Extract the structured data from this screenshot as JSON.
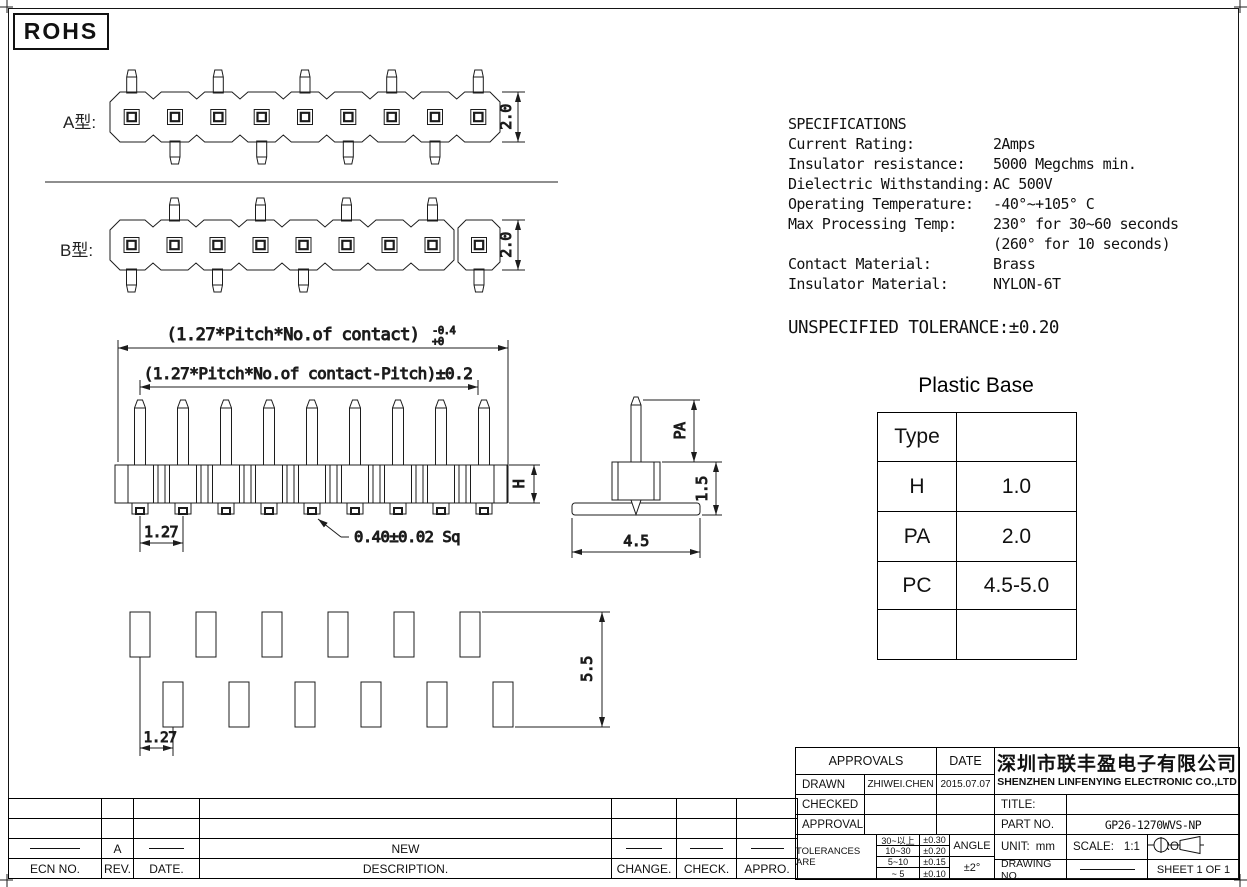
{
  "badge": {
    "rohs": "ROHS"
  },
  "views": {
    "type_a_label": "A型:",
    "type_b_label": "B型:"
  },
  "dims": {
    "a_height": "2.0",
    "b_height": "2.0",
    "total_len": "(1.27*Pitch*No.of contact)",
    "total_len_tol_upper": "-0.4",
    "total_len_tol_lower": "+0",
    "span_len": "(1.27*Pitch*No.of contact-Pitch)±0.2",
    "pitch": "1.27",
    "pin_square": "0.40±0.02 Sq",
    "body_h": "H",
    "pin_above": "PA",
    "base_th": "1.5",
    "base_w": "4.5",
    "pad_span": "5.5",
    "pad_pitch": "1.27"
  },
  "specs": {
    "title": "SPECIFICATIONS",
    "rows": [
      {
        "label": "Current Rating:",
        "value": "2Amps"
      },
      {
        "label": "Insulator resistance:",
        "value": "5000 Megchms min."
      },
      {
        "label": "Dielectric Withstanding:",
        "value": "AC 500V"
      },
      {
        "label": "Operating Temperature:",
        "value": "-40°~+105° C"
      },
      {
        "label": "Max Processing Temp:",
        "value": "230° for 30~60 seconds"
      },
      {
        "label": "",
        "value": "(260° for 10 seconds)"
      },
      {
        "label": "Contact Material:",
        "value": "Brass"
      },
      {
        "label": "Insulator Material:",
        "value": "NYLON-6T"
      }
    ],
    "tolerance_note": "UNSPECIFIED TOLERANCE:±0.20"
  },
  "plastic_table": {
    "title": "Plastic Base",
    "rows": [
      {
        "label": "Type",
        "value": ""
      },
      {
        "label": "H",
        "value": "1.0"
      },
      {
        "label": "PA",
        "value": "2.0"
      },
      {
        "label": "PC",
        "value": "4.5-5.0"
      },
      {
        "label": "",
        "value": ""
      }
    ]
  },
  "revision_table": {
    "headers": [
      "ECN NO.",
      "REV.",
      "DATE.",
      "DESCRIPTION.",
      "CHANGE.",
      "CHECK.",
      "APPRO."
    ],
    "entry": {
      "rev": "A",
      "description": "NEW"
    }
  },
  "title_block": {
    "approvals_header": "APPROVALS",
    "date_header": "DATE",
    "drawn_label": "DRAWN",
    "drawn_name": "ZHIWEI.CHEN",
    "drawn_date": "2015.07.07",
    "checked_label": "CHECKED",
    "approvals_label": "APPROVALS",
    "tolerances_label": "TOLERANCES ARE",
    "tolerance_rows": [
      {
        "range": "30~以上",
        "tol": "±0.30"
      },
      {
        "range": "10~30",
        "tol": "±0.20"
      },
      {
        "range": "5~10",
        "tol": "±0.15"
      },
      {
        "range": "~ 5",
        "tol": "±0.10"
      }
    ],
    "angle_label": "ANGLE",
    "angle_tol": "±2°",
    "company_cn": "深圳市联丰盈电子有限公司",
    "company_en": "SHENZHEN LINFENYING ELECTRONIC CO.,LTD",
    "title_label": "TITLE:",
    "part_no_label": "PART NO.",
    "part_no_value": "GP26-1270WVS-NP",
    "unit_label": "UNIT:",
    "unit_value": "mm",
    "scale_label": "SCALE:",
    "scale_value": "1:1",
    "proj_label": "PROJ:",
    "drawing_no_label": "DRAWING NO.",
    "sheet_label": "SHEET  1 OF 1"
  }
}
